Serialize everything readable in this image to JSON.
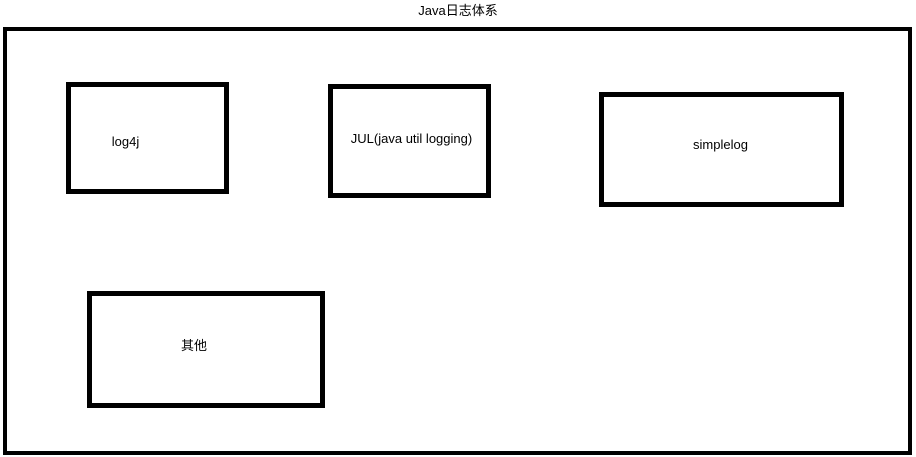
{
  "diagram": {
    "title": "Java日志体系",
    "colors": {
      "border": "#000000",
      "background": "#ffffff",
      "text": "#000000"
    },
    "nodes": [
      {
        "id": "log4j",
        "label": "log4j"
      },
      {
        "id": "jul",
        "label": "JUL(java util logging)"
      },
      {
        "id": "simplelog",
        "label": "simplelog"
      },
      {
        "id": "other",
        "label": "其他"
      }
    ]
  }
}
